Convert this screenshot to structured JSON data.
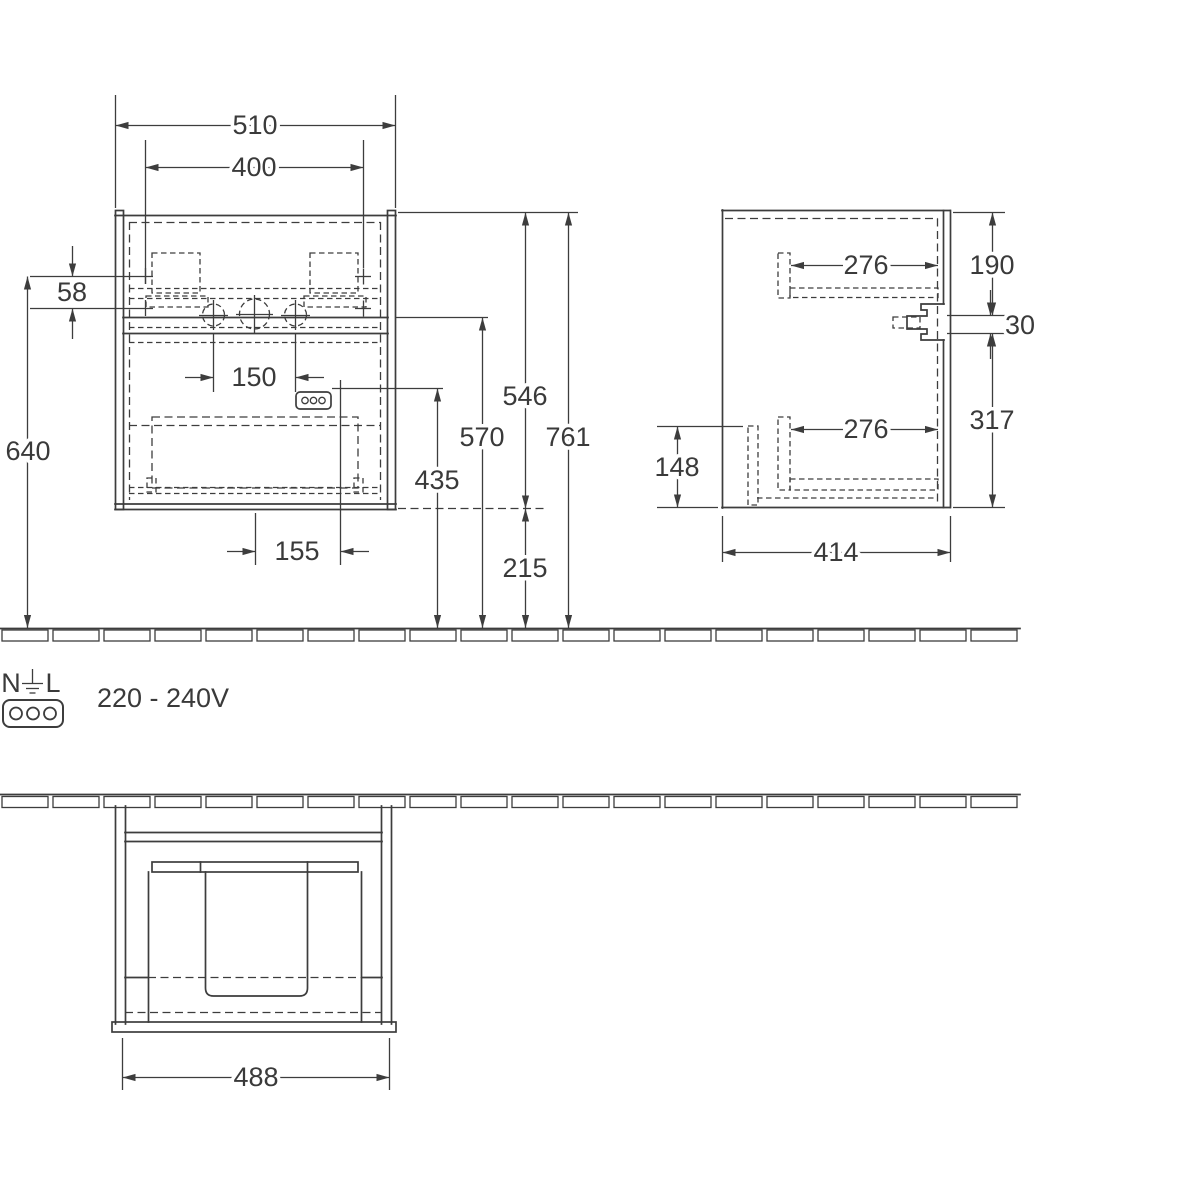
{
  "dims": {
    "front": {
      "overall_width": "510",
      "fixing_width": "400",
      "fixing_gap": "58",
      "fixing_height": "640",
      "tap_spacing": "150",
      "socket_offset": "155",
      "socket_height": "435",
      "tap_height": "570",
      "cabinet_height": "546",
      "clearance": "215",
      "total_height": "761"
    },
    "side": {
      "upper_depth": "276",
      "upper_offset": "190",
      "bracket_height": "30",
      "lower_offset": "317",
      "lower_depth": "276",
      "lower_height": "148",
      "depth": "414"
    },
    "plan": {
      "cutout_width": "488"
    }
  },
  "legend": {
    "neutral": "N",
    "line": "L",
    "voltage": "220 - 240V"
  },
  "colors": {
    "line": "#3d3d3d",
    "text": "#3a3a3a",
    "background": "#ffffff"
  }
}
